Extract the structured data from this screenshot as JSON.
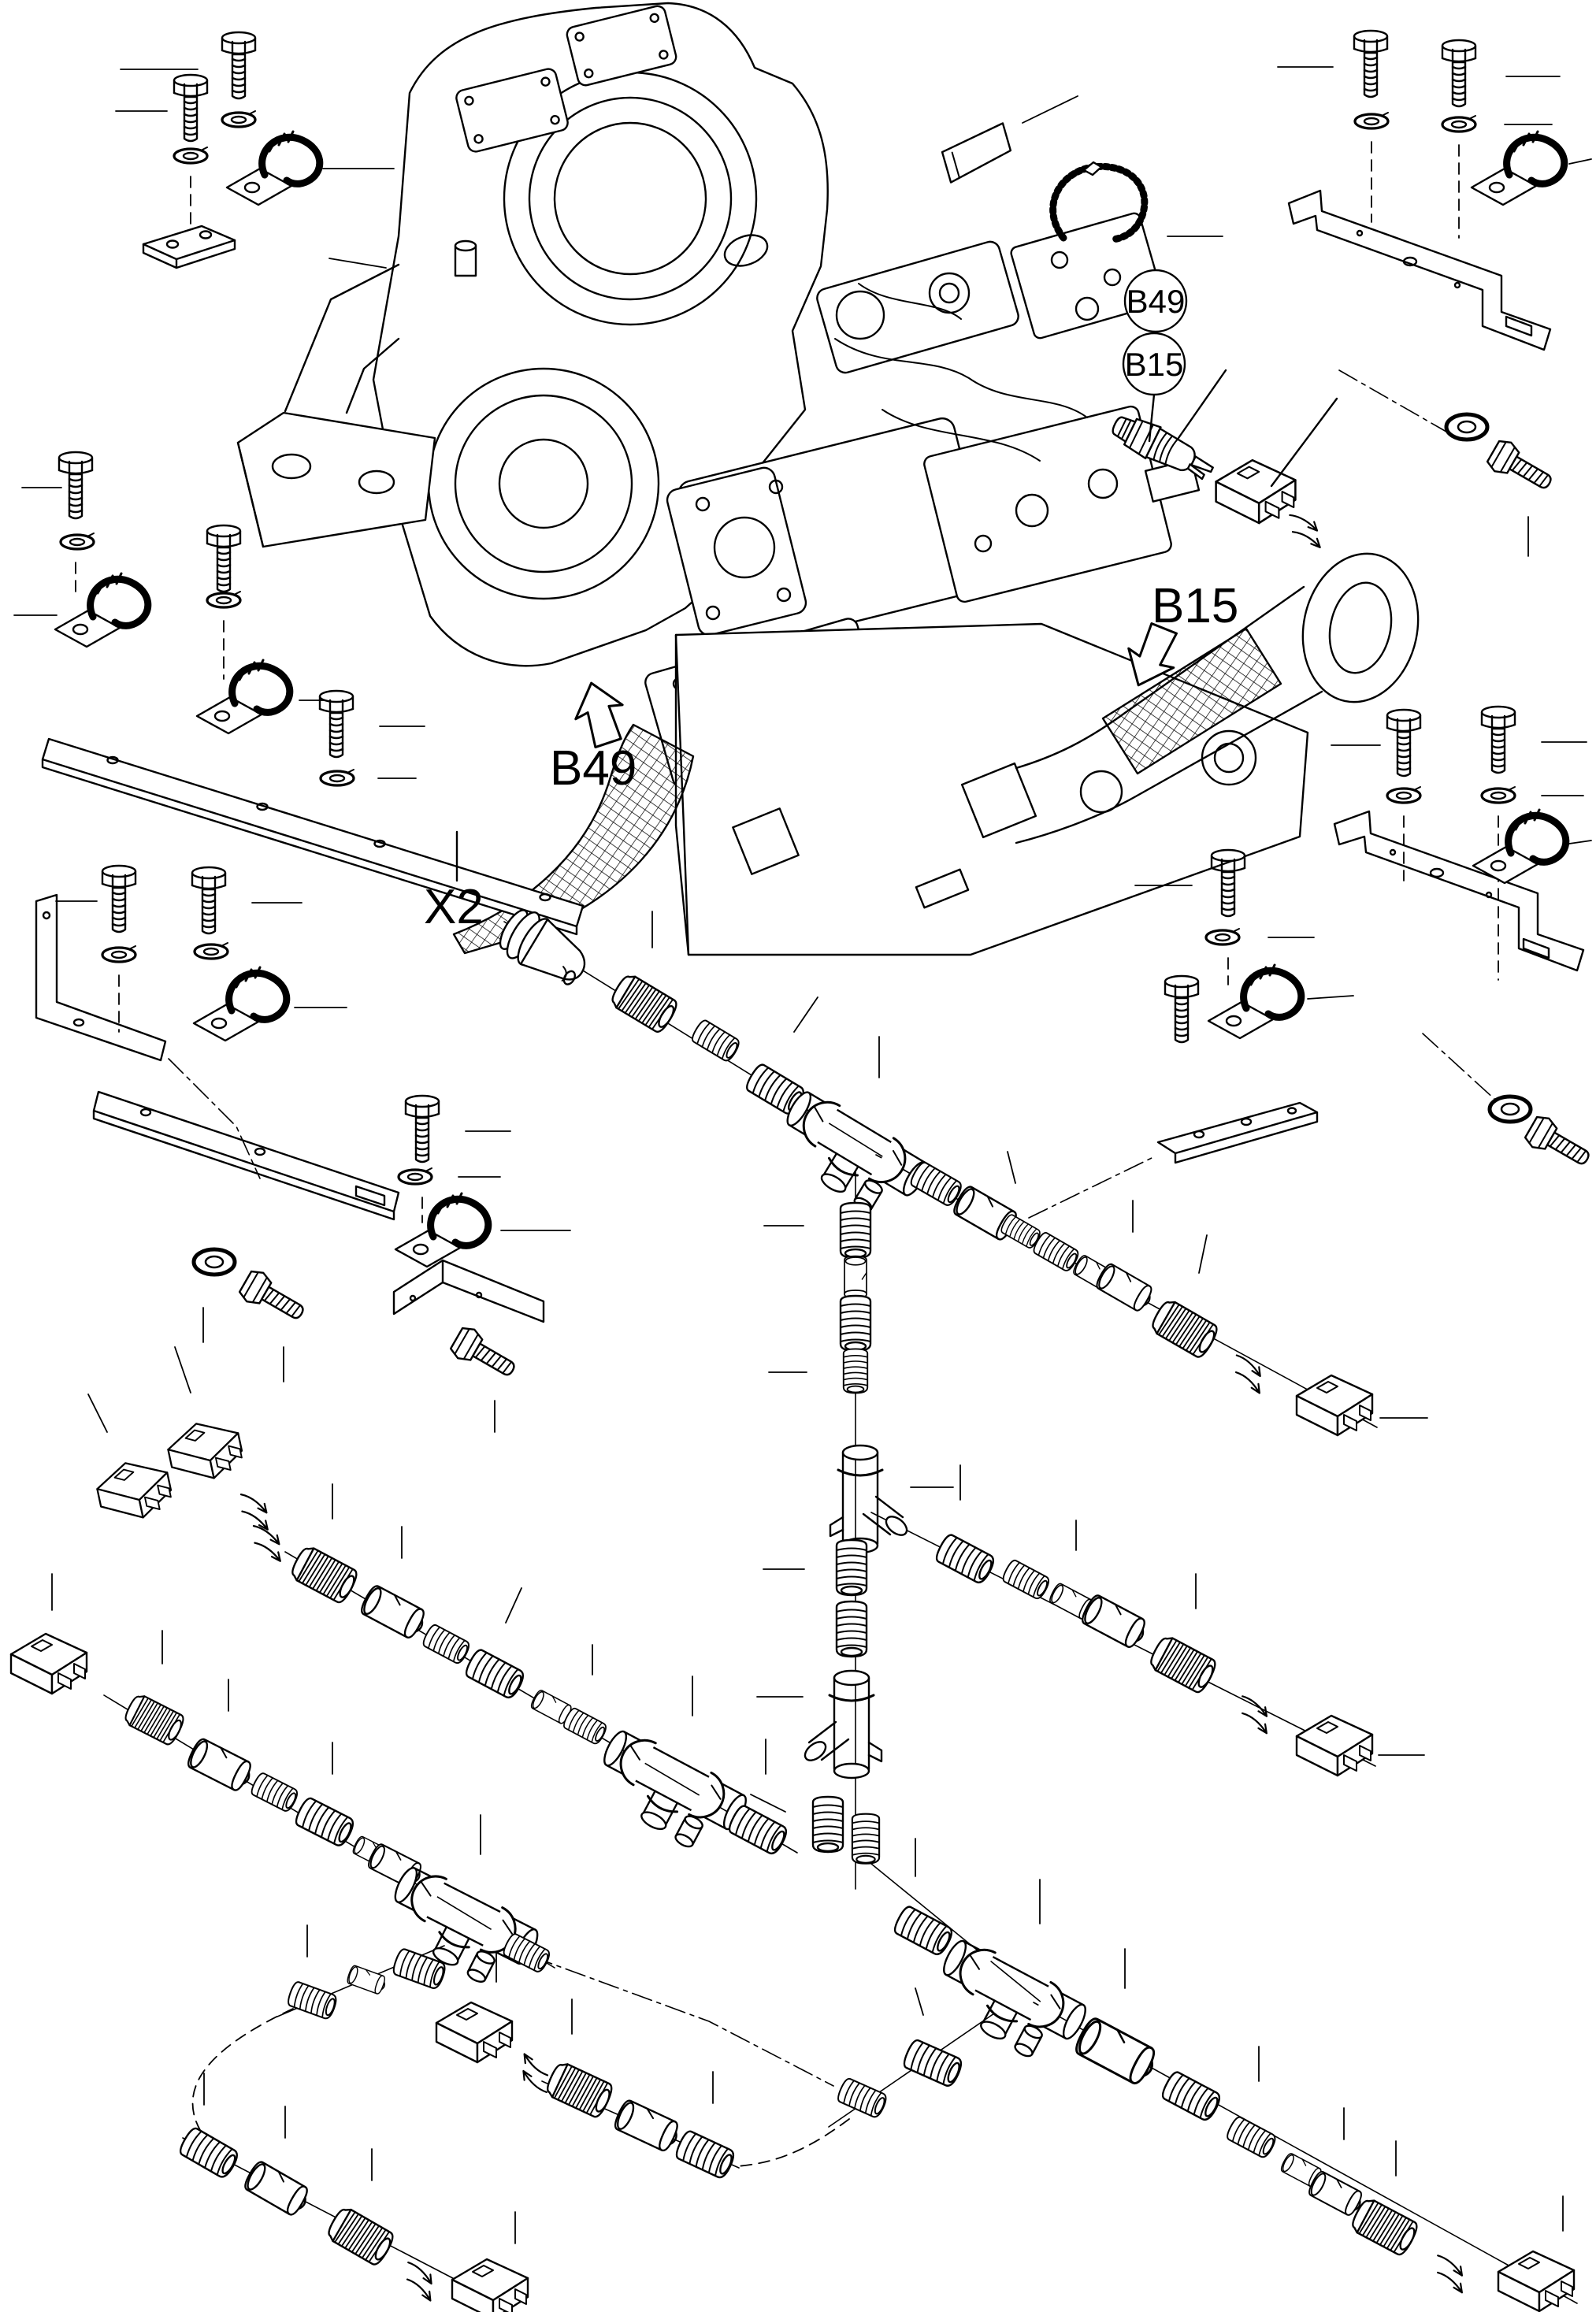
{
  "diagram": {
    "type": "exploded-parts-diagram",
    "background_color": "#ffffff",
    "line_color": "#000000",
    "callout_balloons": [
      {
        "id": "B49",
        "label": "B49"
      },
      {
        "id": "B15",
        "label": "B15"
      }
    ],
    "arrow_labels": [
      {
        "id": "B15",
        "text": "B15",
        "direction": "down-left"
      },
      {
        "id": "B49",
        "text": "B49",
        "direction": "up"
      }
    ],
    "connector_label": {
      "text": "X2"
    },
    "part_names": {
      "bolt": "hex-bolt",
      "washer": "lock-washer",
      "fwasher": "flat-washer",
      "clamp": "cable-clamp",
      "plate": "clamp-plate",
      "screw": "hex-screw",
      "thr": "threaded-fitting",
      "knurl": "knurled-coupling-nut",
      "cyl": "coupling-sleeve",
      "tee": "tee-fitting",
      "yfit": "branch-fitting",
      "conn": "two-pin-connector",
      "wir": "wire-leads",
      "sensor": "temperature-sensor",
      "xconn": "x2-bulkhead-connector",
      "tag": "label-tag",
      "tie": "cable-tie"
    }
  }
}
